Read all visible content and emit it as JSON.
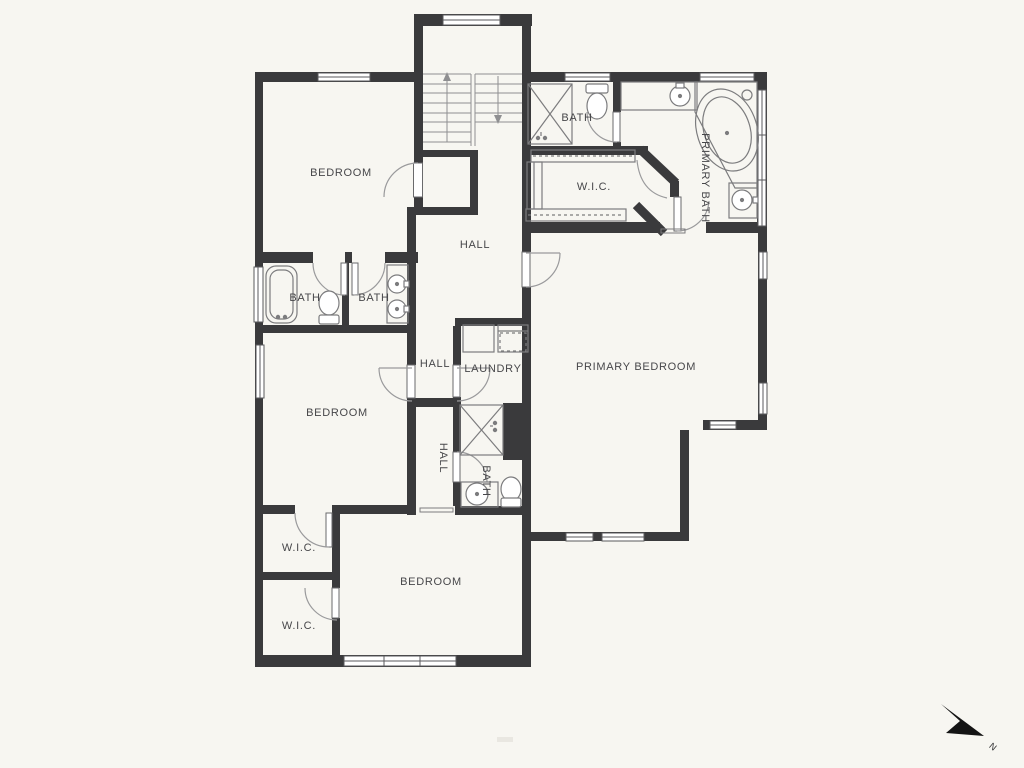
{
  "plan": {
    "type": "floor-plan",
    "rooms": [
      {
        "id": "bedroom-top-left",
        "text": "BEDROOM"
      },
      {
        "id": "bath-top",
        "text": "BATH"
      },
      {
        "id": "wic-primary",
        "text": "W.I.C."
      },
      {
        "id": "primary-bath",
        "text": "PRIMARY BATH"
      },
      {
        "id": "hall-upper",
        "text": "HALL"
      },
      {
        "id": "primary-bedroom",
        "text": "PRIMARY BEDROOM"
      },
      {
        "id": "bath-left-tub",
        "text": "BATH"
      },
      {
        "id": "bath-left-sinks",
        "text": "BATH"
      },
      {
        "id": "hall-mid",
        "text": "HALL"
      },
      {
        "id": "laundry",
        "text": "LAUNDRY"
      },
      {
        "id": "bedroom-mid-left",
        "text": "BEDROOM"
      },
      {
        "id": "hall-corridor",
        "text": "HALL"
      },
      {
        "id": "bath-mid",
        "text": "BATH"
      },
      {
        "id": "wic-1",
        "text": "W.I.C."
      },
      {
        "id": "wic-2",
        "text": "W.I.C."
      },
      {
        "id": "bedroom-bottom",
        "text": "BEDROOM"
      }
    ],
    "compass": {
      "label": "N"
    },
    "colors": {
      "background": "#f7f6f1",
      "wall": "#3a3a3c",
      "fixture_line": "#7c7c7e",
      "swing_line": "#9a9a9c",
      "label_text": "#47474a",
      "compass_fill": "#141414"
    }
  }
}
